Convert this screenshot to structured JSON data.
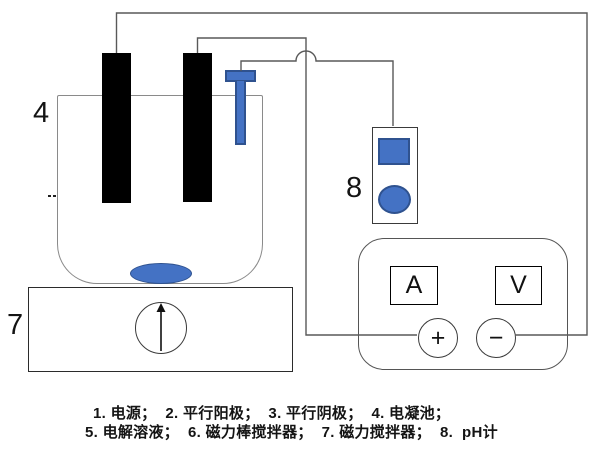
{
  "callouts": {
    "power_supply": "1",
    "parallel_anode": "2",
    "parallel_cathode": "3",
    "electrocoagulation_cell": "4",
    "electrolyte_solution": "5",
    "magnetic_stir_bar": "6",
    "magnetic_stirrer": "7",
    "ph_meter": "8"
  },
  "power_supply": {
    "ammeter_label": "A",
    "voltmeter_label": "V",
    "positive_terminal": "+",
    "negative_terminal": "−"
  },
  "caption": {
    "line1": "1. 电源；  2. 平行阳极；  3. 平行阴极；  4. 电凝池；",
    "line2": "5. 电解溶液；  6. 磁力棒搅拌器；  7. 磁力搅拌器；  8.  pH计"
  },
  "colors": {
    "component_blue": "#4472C4",
    "component_blue_border": "#2F528F",
    "electrode_black": "#000000",
    "wire_gray": "#595959"
  }
}
